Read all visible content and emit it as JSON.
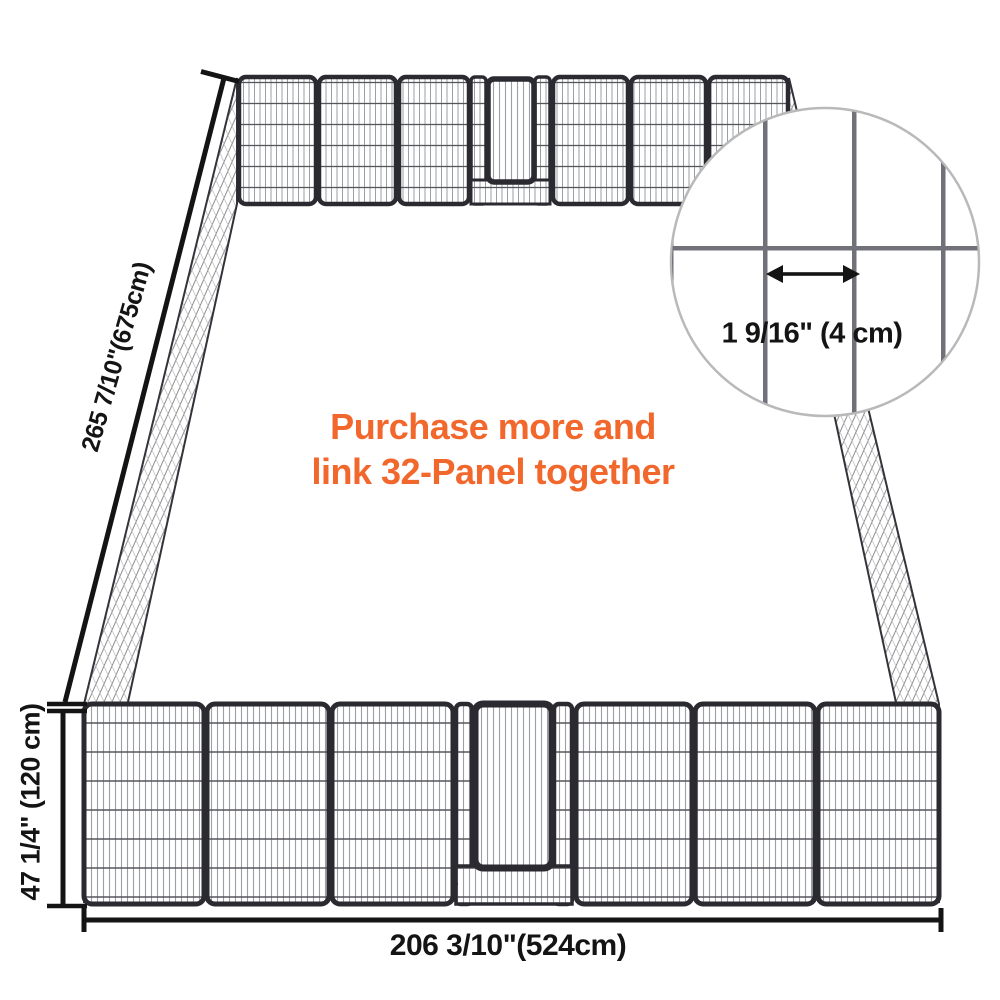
{
  "promo": {
    "line1": "Purchase more and",
    "line2": "link 32-Panel together"
  },
  "dimensions": {
    "side": "265 7/10\"(675cm)",
    "height": "47 1/4\" (120 cm)",
    "width": "206 3/10\"(524cm)"
  },
  "inset": {
    "mesh_gap_label": "1 9/16\" (4 cm)"
  },
  "icons": {
    "mesh_gap_arrow": "double-headed-horizontal-arrow"
  },
  "colors": {
    "promo_orange": "#f2672c",
    "dimension_ink": "#141414",
    "frame_dark": "#2a2a30",
    "mesh_light": "#9aa0a6",
    "mesh_dark": "#55555c",
    "hatch_gray": "#8f8f8f",
    "hatch_light": "#c2c2c2",
    "inset_bar_gray": "#71717a",
    "inset_ring_gray": "#b9b9b9"
  }
}
